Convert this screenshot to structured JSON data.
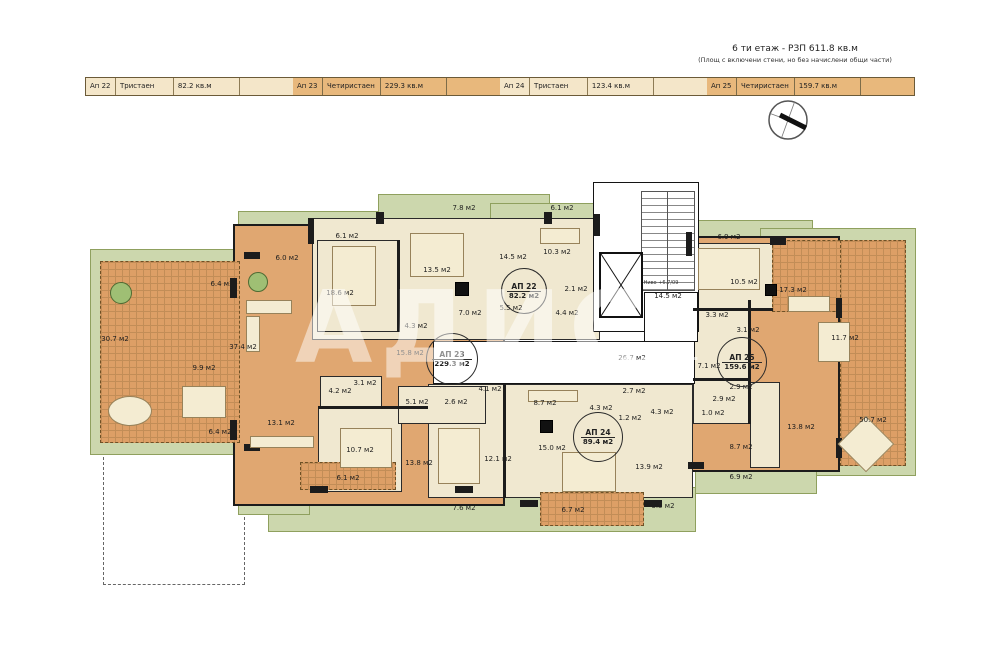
{
  "header": {
    "title": "6 ти етаж - РЗП 611.8 кв.м",
    "subtitle": "(Площ с включени стени, но без начислени общи части)"
  },
  "table": {
    "rows": [
      {
        "num": "Ап 22",
        "type": "Тристаен",
        "area": "82.2 кв.м",
        "note": "",
        "hl": false
      },
      {
        "num": "Ап 23",
        "type": "Четиристаен",
        "area": "229.3 кв.м",
        "note": "",
        "hl": true
      },
      {
        "num": "Ап 24",
        "type": "Тристаен",
        "area": "123.4 кв.м",
        "note": "",
        "hl": false
      },
      {
        "num": "Ап 25",
        "type": "Четиристаен",
        "area": "159.7 кв.м",
        "note": "",
        "hl": true
      }
    ]
  },
  "apartments": [
    {
      "id": "АП 22",
      "area": "82.2 м2",
      "x": 524,
      "y": 291,
      "d": 46
    },
    {
      "id": "АП 23",
      "area": "229.3 м2",
      "x": 452,
      "y": 359,
      "d": 52
    },
    {
      "id": "АП 24",
      "area": "89.4 м2",
      "x": 598,
      "y": 437,
      "d": 50
    },
    {
      "id": "АП 25",
      "area": "159.6 м2",
      "x": 742,
      "y": 362,
      "d": 50
    }
  ],
  "rooms": [
    {
      "t": "30.7 м2",
      "x": 115,
      "y": 339
    },
    {
      "t": "6.0 м2",
      "x": 287,
      "y": 258
    },
    {
      "t": "6.4 м2",
      "x": 222,
      "y": 284
    },
    {
      "t": "37.4 м2",
      "x": 243,
      "y": 347
    },
    {
      "t": "9.9 м2",
      "x": 204,
      "y": 368
    },
    {
      "t": "13.1 м2",
      "x": 281,
      "y": 423
    },
    {
      "t": "6.4 м2",
      "x": 220,
      "y": 432
    },
    {
      "t": "6.1 м2",
      "x": 347,
      "y": 236
    },
    {
      "t": "18.6 м2",
      "x": 340,
      "y": 293
    },
    {
      "t": "13.5 м2",
      "x": 437,
      "y": 270
    },
    {
      "t": "4.3 м2",
      "x": 416,
      "y": 326
    },
    {
      "t": "7.0 м2",
      "x": 470,
      "y": 313
    },
    {
      "t": "5.5 м2",
      "x": 511,
      "y": 308
    },
    {
      "t": "15.8 м2",
      "x": 410,
      "y": 353
    },
    {
      "t": "4.2 м2",
      "x": 340,
      "y": 391
    },
    {
      "t": "3.1 м2",
      "x": 365,
      "y": 383
    },
    {
      "t": "5.1 м2",
      "x": 417,
      "y": 402
    },
    {
      "t": "2.6 м2",
      "x": 456,
      "y": 402
    },
    {
      "t": "10.7 м2",
      "x": 360,
      "y": 450
    },
    {
      "t": "13.8 м2",
      "x": 419,
      "y": 463
    },
    {
      "t": "6.1 м2",
      "x": 348,
      "y": 478
    },
    {
      "t": "7.6 м2",
      "x": 464,
      "y": 508
    },
    {
      "t": "7.8 м2",
      "x": 464,
      "y": 208
    },
    {
      "t": "6.1 м2",
      "x": 562,
      "y": 208
    },
    {
      "t": "14.5 м2",
      "x": 513,
      "y": 257
    },
    {
      "t": "10.3 м2",
      "x": 557,
      "y": 252
    },
    {
      "t": "2.1 м2",
      "x": 576,
      "y": 289
    },
    {
      "t": "4.4 м2",
      "x": 567,
      "y": 313
    },
    {
      "t": "14.5 м2",
      "x": 668,
      "y": 296
    },
    {
      "t": "26.7 м2",
      "x": 632,
      "y": 358
    },
    {
      "t": "4.1 м2",
      "x": 490,
      "y": 389
    },
    {
      "t": "12.1 м2",
      "x": 498,
      "y": 459
    },
    {
      "t": "8.7 м2",
      "x": 545,
      "y": 403
    },
    {
      "t": "2.7 м2",
      "x": 634,
      "y": 391
    },
    {
      "t": "4.3 м2",
      "x": 601,
      "y": 408
    },
    {
      "t": "1.2 м2",
      "x": 630,
      "y": 418
    },
    {
      "t": "4.3 м2",
      "x": 662,
      "y": 412
    },
    {
      "t": "15.0 м2",
      "x": 552,
      "y": 448
    },
    {
      "t": "13.9 м2",
      "x": 649,
      "y": 467
    },
    {
      "t": "6.7 м2",
      "x": 573,
      "y": 510
    },
    {
      "t": "3.5 м2",
      "x": 663,
      "y": 506
    },
    {
      "t": "6.9 м2",
      "x": 729,
      "y": 237
    },
    {
      "t": "10.5 м2",
      "x": 744,
      "y": 282
    },
    {
      "t": "17.3 м2",
      "x": 793,
      "y": 290
    },
    {
      "t": "3.3 м2",
      "x": 717,
      "y": 315
    },
    {
      "t": "3.1 м2",
      "x": 748,
      "y": 330
    },
    {
      "t": "7.1 м2",
      "x": 709,
      "y": 366
    },
    {
      "t": "2.9 м2",
      "x": 741,
      "y": 387
    },
    {
      "t": "2.9 м2",
      "x": 724,
      "y": 399
    },
    {
      "t": "1.0 м2",
      "x": 713,
      "y": 413
    },
    {
      "t": "11.7 м2",
      "x": 845,
      "y": 338
    },
    {
      "t": "13.8 м2",
      "x": 801,
      "y": 427
    },
    {
      "t": "8.7 м2",
      "x": 741,
      "y": 447
    },
    {
      "t": "6.9 м2",
      "x": 741,
      "y": 477
    },
    {
      "t": "50.7 м2",
      "x": 873,
      "y": 420
    }
  ],
  "core": {
    "level_note": "Ниво +6.7/09"
  },
  "watermark": {
    "brand": "АДИС",
    "site": "адрес.бг"
  },
  "colors": {
    "floor_orange": "#e0a771",
    "floor_cream": "#f0e8d0",
    "terrace_green": "#ccd7ad",
    "table_light": "#f4e6c9",
    "table_highlight": "#e8b87c",
    "wall": "#1c1c1c"
  }
}
